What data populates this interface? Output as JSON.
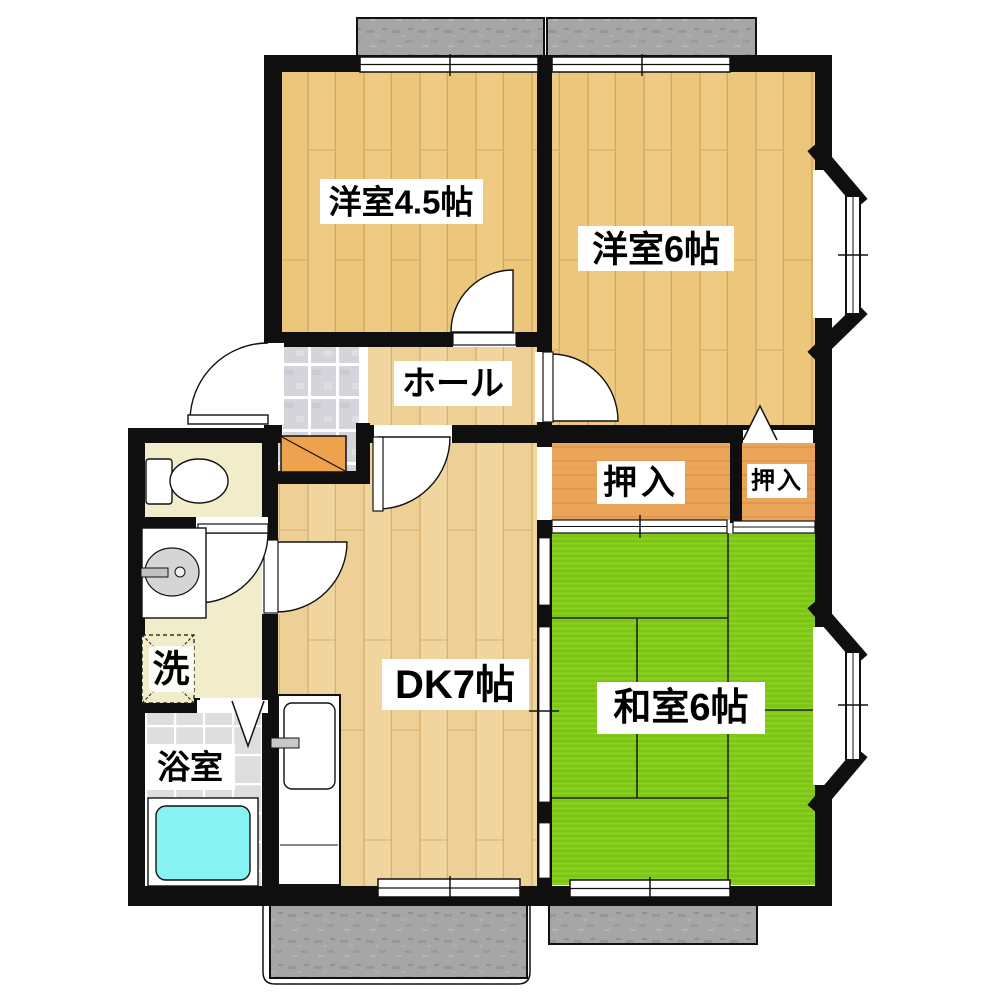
{
  "type": "floor-plan",
  "rooms": {
    "western_room_4_5": {
      "label": "洋室4.5帖"
    },
    "western_room_6": {
      "label": "洋室6帖"
    },
    "hall": {
      "label": "ホール"
    },
    "closet_large": {
      "label": "押入"
    },
    "closet_small": {
      "label": "押入"
    },
    "dining_kitchen": {
      "label": "DK7帖"
    },
    "japanese_room_6": {
      "label": "和室6帖"
    },
    "laundry": {
      "label": "洗"
    },
    "bathroom": {
      "label": "浴室"
    }
  },
  "colors": {
    "wall": "#0f0f0f",
    "wood_floor": "#eeca82",
    "wood_floor_dk": "#efd49c",
    "tatami_green": "#83ca1b",
    "closet_wood": "#eba55a",
    "genkan_step_orange": "#efa24e",
    "bathtub_cyan": "#86f2f2",
    "balcony_gray": "#a6a6a6",
    "wet_area_cream": "#f1edcb",
    "bath_tile_gray": "#dedede",
    "genkan_tile_gray": "#d4d4da"
  }
}
